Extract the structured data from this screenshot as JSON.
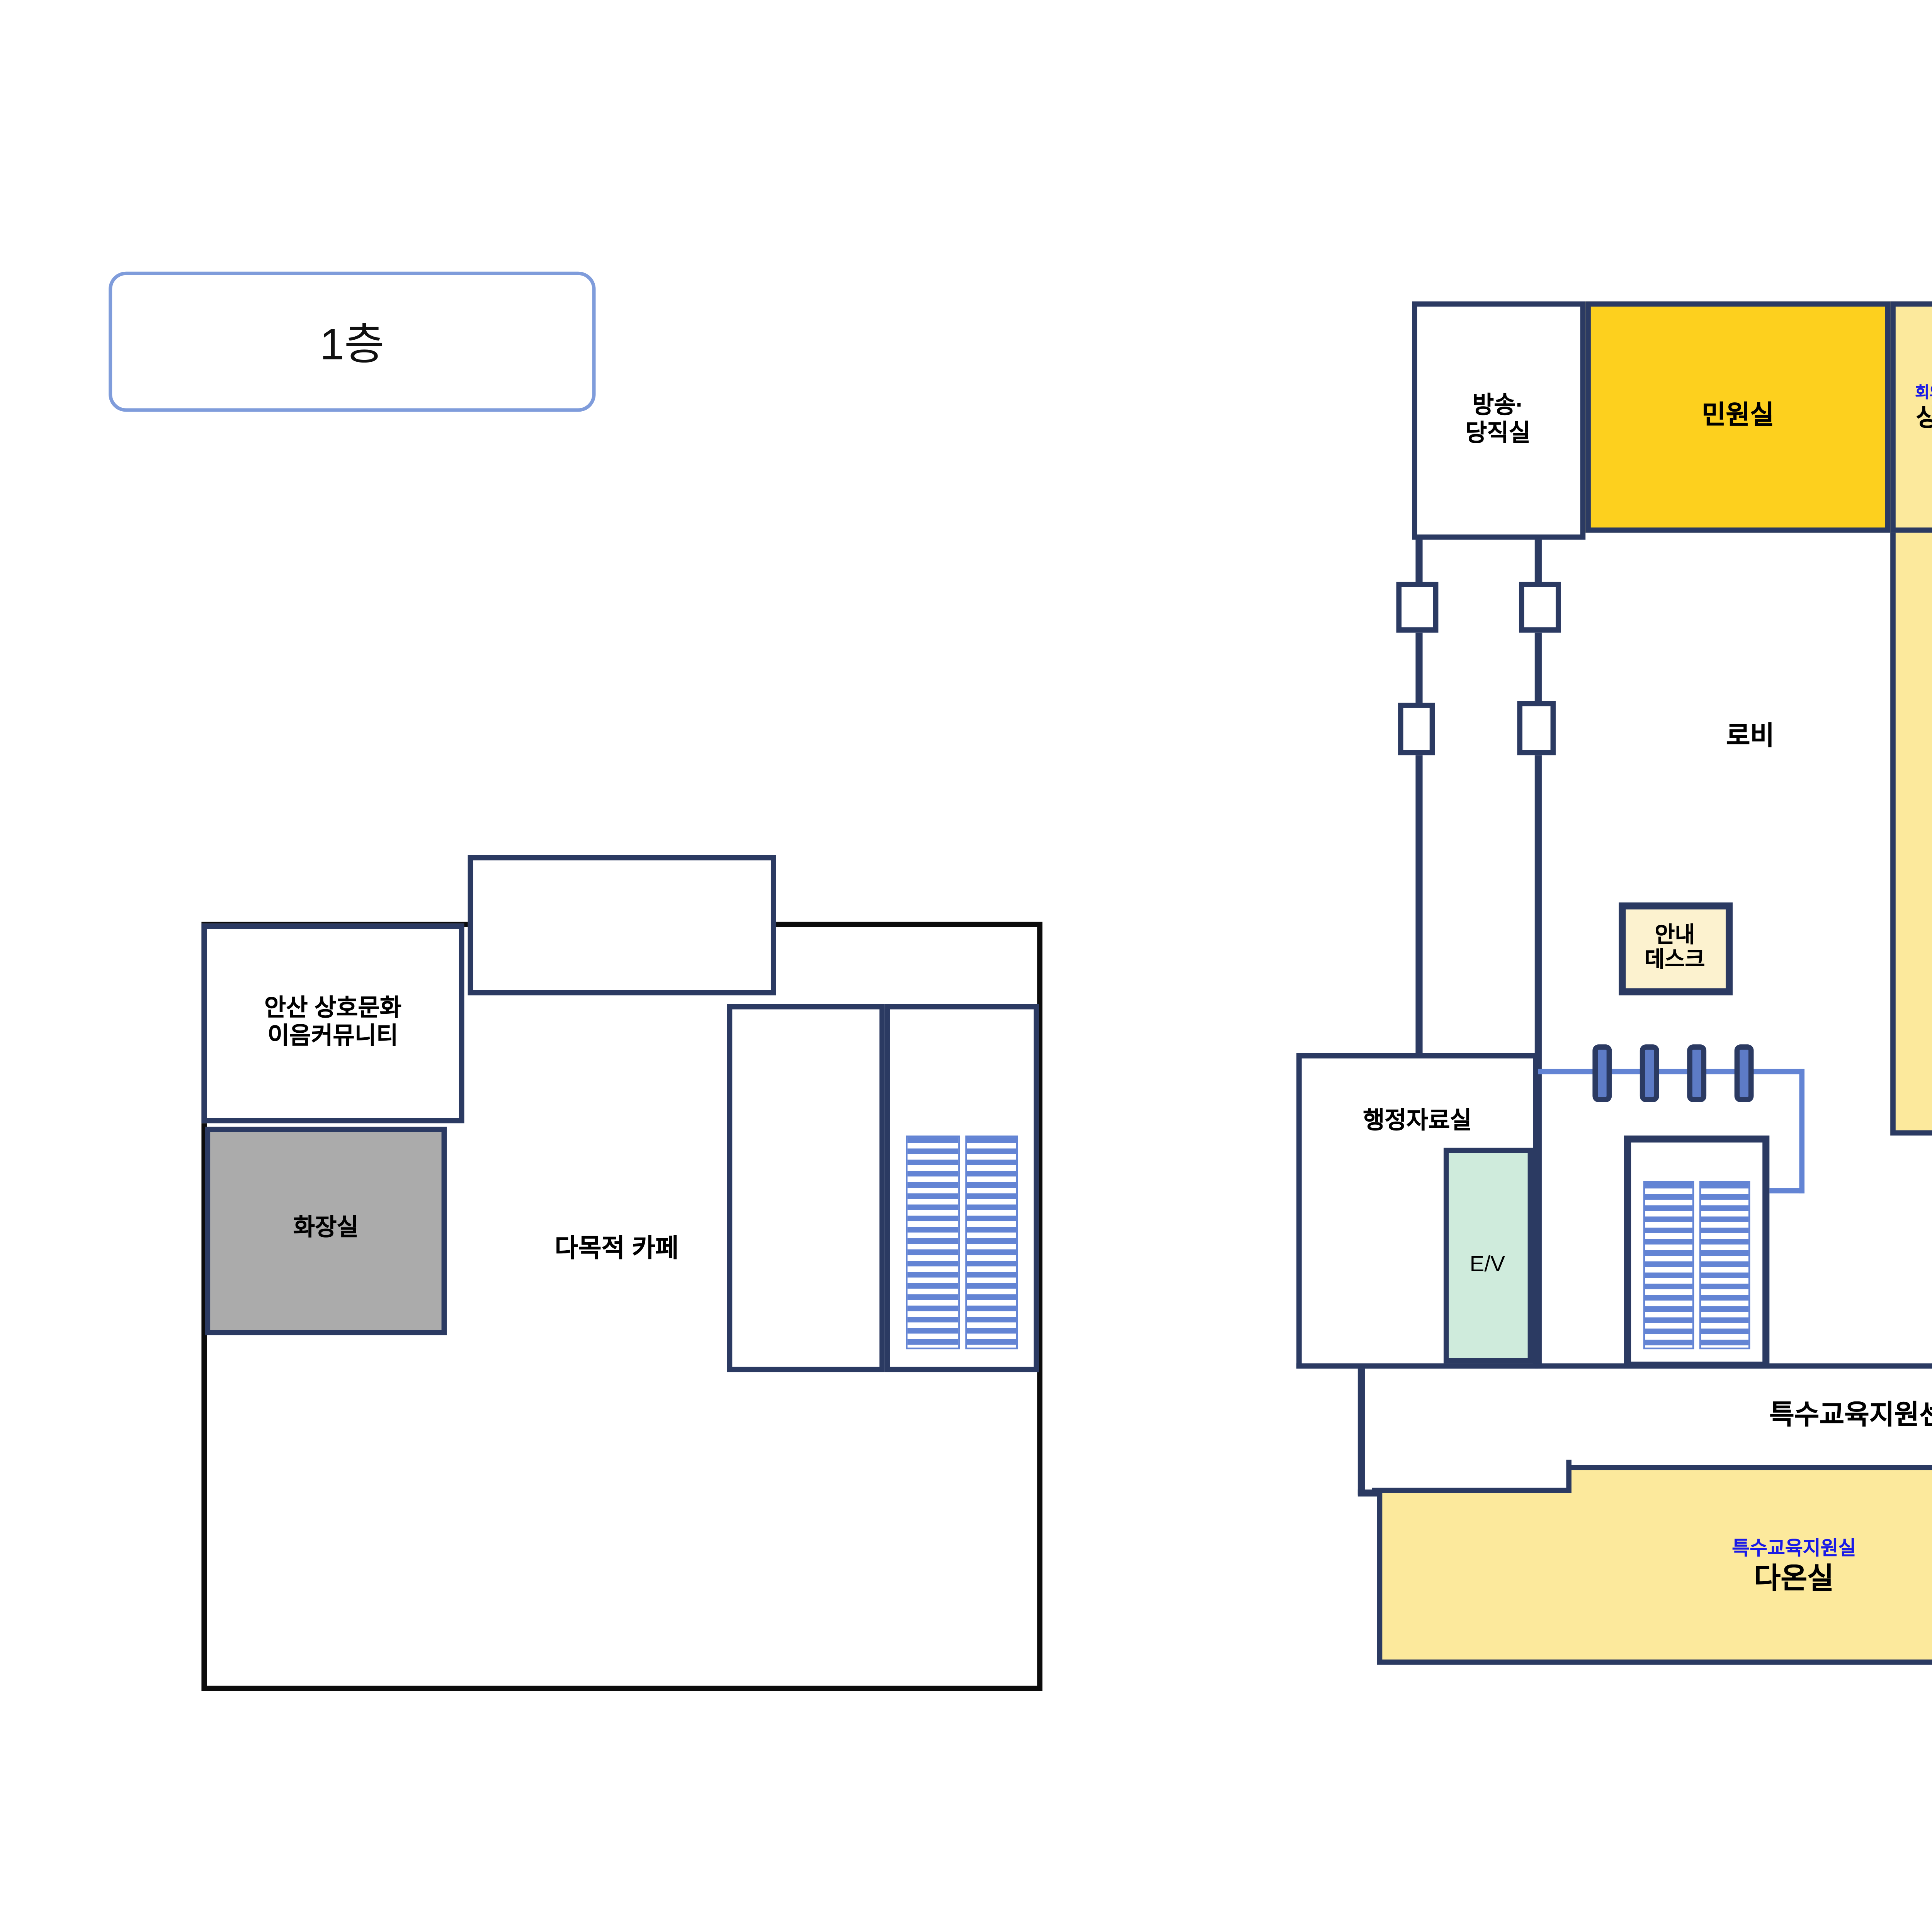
{
  "floor_badge": {
    "label": "1층"
  },
  "colors": {
    "wall_navy": "#2b3a62",
    "wall_black": "#0c0c0c",
    "room_yellow": "#fce99c",
    "minwon_gold": "#fdd01e",
    "toilet_gray": "#ababab",
    "elevator_green": "#cfebdc",
    "desk_cream": "#fcf2cf",
    "stair_blue": "#6384d4",
    "label_blue": "#1a1ae6",
    "badge_border": "#7f9cdb"
  },
  "left_building": {
    "community": {
      "line1": "안산 상호문화",
      "line2": "이음커뮤니티"
    },
    "toilet": {
      "name": "화장실"
    },
    "cafe": {
      "name": "다목적 카페"
    }
  },
  "right_building": {
    "broadcast": {
      "line1": "방송·",
      "line2": "당직실"
    },
    "minwon": {
      "name": "민원실"
    },
    "meeting101": {
      "sub": "회의실101",
      "name": "상록실"
    },
    "meeting102": {
      "sub": "회의실102",
      "name": "단원실"
    },
    "meeting103": {
      "sub": "회의실103",
      "name": "성호실"
    },
    "lobby": {
      "name": "로비"
    },
    "field_support": {
      "name": "현장지원실"
    },
    "info_desk": {
      "line1": "안내",
      "line2": "데스크"
    },
    "admin_archive": {
      "name": "행정자료실"
    },
    "elevator": {
      "name": "E/V"
    },
    "toilet": {
      "name": "화장실"
    },
    "sped_center": {
      "name": "특수교육지원센터"
    },
    "neulpum": {
      "sub": "진단평가실",
      "name": "늘품실"
    },
    "dasom": {
      "sub": "교육상담실",
      "name": "다솜실"
    },
    "daon": {
      "sub": "특수교육지원실",
      "name": "다온실"
    },
    "narae": {
      "sub": "보조공학실",
      "name": "나래실"
    },
    "nuri": {
      "sub": "치료지원실",
      "name": "누리실"
    },
    "dodam": {
      "sub": "영아교실",
      "name": "도담실"
    }
  }
}
